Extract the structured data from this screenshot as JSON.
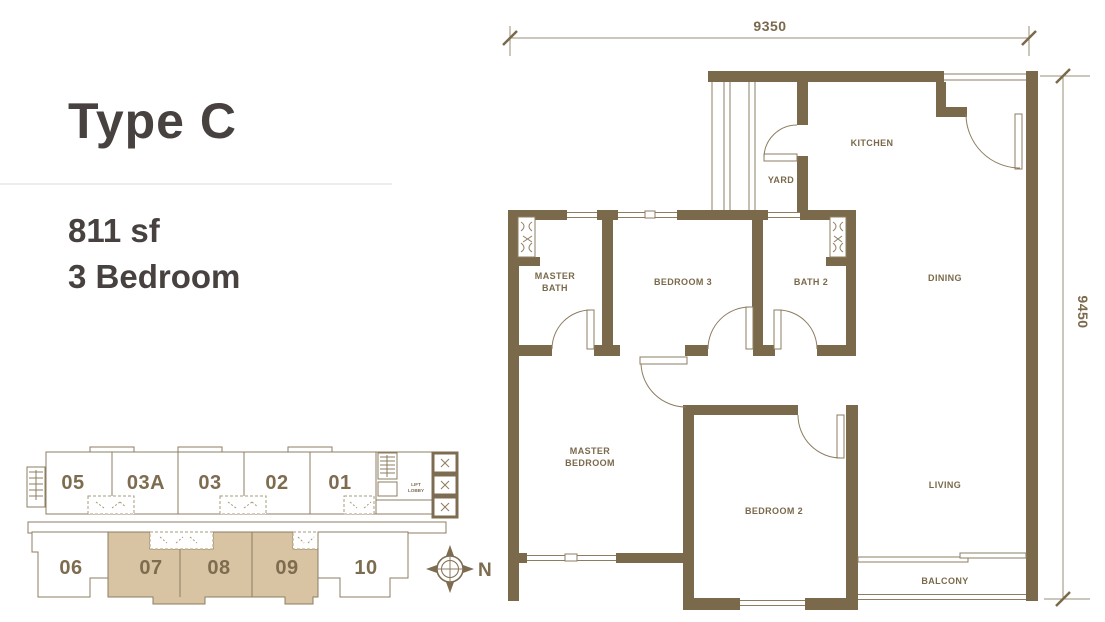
{
  "title_block": {
    "title": "Type C",
    "area": "811 sf",
    "bedrooms": "3 Bedroom"
  },
  "floor_plan": {
    "dim_top": "9350",
    "dim_right": "9450",
    "rooms": {
      "kitchen": "KITCHEN",
      "yard": "YARD",
      "master_bath_l1": "MASTER",
      "master_bath_l2": "BATH",
      "bedroom3": "BEDROOM 3",
      "bath2": "BATH 2",
      "dining": "DINING",
      "master_bedroom_l1": "MASTER",
      "master_bedroom_l2": "BEDROOM",
      "bedroom2": "BEDROOM 2",
      "living": "LIVING",
      "balcony": "BALCONY"
    },
    "colors": {
      "wall": "#7a694b",
      "thin_line": "#8d7d60"
    }
  },
  "key_plan": {
    "top_units": [
      "05",
      "03A",
      "03",
      "02",
      "01"
    ],
    "bottom_units": [
      "06",
      "07",
      "08",
      "09",
      "10"
    ],
    "highlighted_units": [
      "07",
      "08",
      "09"
    ],
    "highlight_color": "#d8c4a3",
    "lift_l1": "LIFT",
    "lift_l2": "LOBBY",
    "north": "N"
  }
}
